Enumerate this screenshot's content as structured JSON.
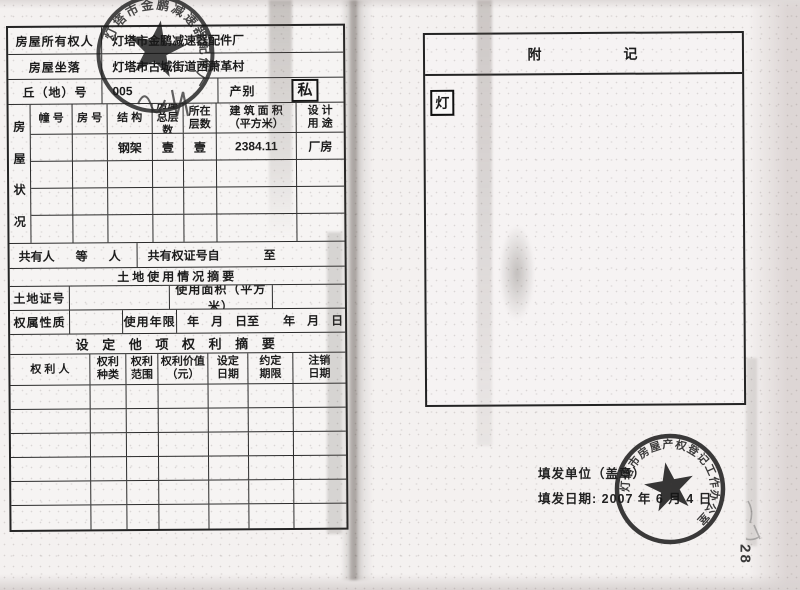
{
  "doc": {
    "owner": {
      "label": "房屋所有权人",
      "value": "灯塔市金鹏减速器配件厂"
    },
    "location": {
      "label": "房屋坐落",
      "value": "灯塔市古城街道西萧革村"
    },
    "plot": {
      "label": "丘（地）号",
      "value": "005"
    },
    "category": {
      "label": "产别",
      "value": "私"
    },
    "condition": {
      "side_chars": [
        "房",
        "屋",
        "状",
        "况"
      ],
      "headers": [
        "幢 号",
        "房 号",
        "结 构",
        "房屋\n总层数",
        "所在\n层数",
        "建 筑 面 积\n（平方米）",
        "设 计\n用 途"
      ],
      "row": {
        "structure": "钢架",
        "total_floors": "壹",
        "floor": "壹",
        "area": "2384.11",
        "use": "厂房"
      }
    },
    "co_owner": {
      "label": "共有人",
      "etc": "等",
      "person": "人",
      "cert_label": "共有权证号自",
      "to": "至"
    },
    "land": {
      "title": "土地使用情况摘要",
      "cert_label": "土地证号",
      "area_label": "使用面积（平方米）",
      "tenure_label": "权属性质",
      "term_label": "使用年限",
      "term_value": "年　月　日至　　年　月　日"
    },
    "rights": {
      "title": "设 定 他 项 权 利 摘 要",
      "headers": [
        "权  利  人",
        "权利\n种类",
        "权利\n范围",
        "权利价值\n（元）",
        "设定\n日期",
        "约定\n期限",
        "注销\n日期"
      ]
    },
    "notes": {
      "title_a": "附",
      "title_b": "记",
      "seal_char": "灯"
    },
    "issue": {
      "unit_label": "填发单位（盖章）",
      "date_label": "填发日期:",
      "date_value": "2007 年 6 月 4 日"
    },
    "stamps": {
      "top_ring": "灯塔市金鹏减速器配件厂",
      "bottom_ring": "灯塔市房屋产权登记工作办公室"
    },
    "margin_number": "28"
  }
}
